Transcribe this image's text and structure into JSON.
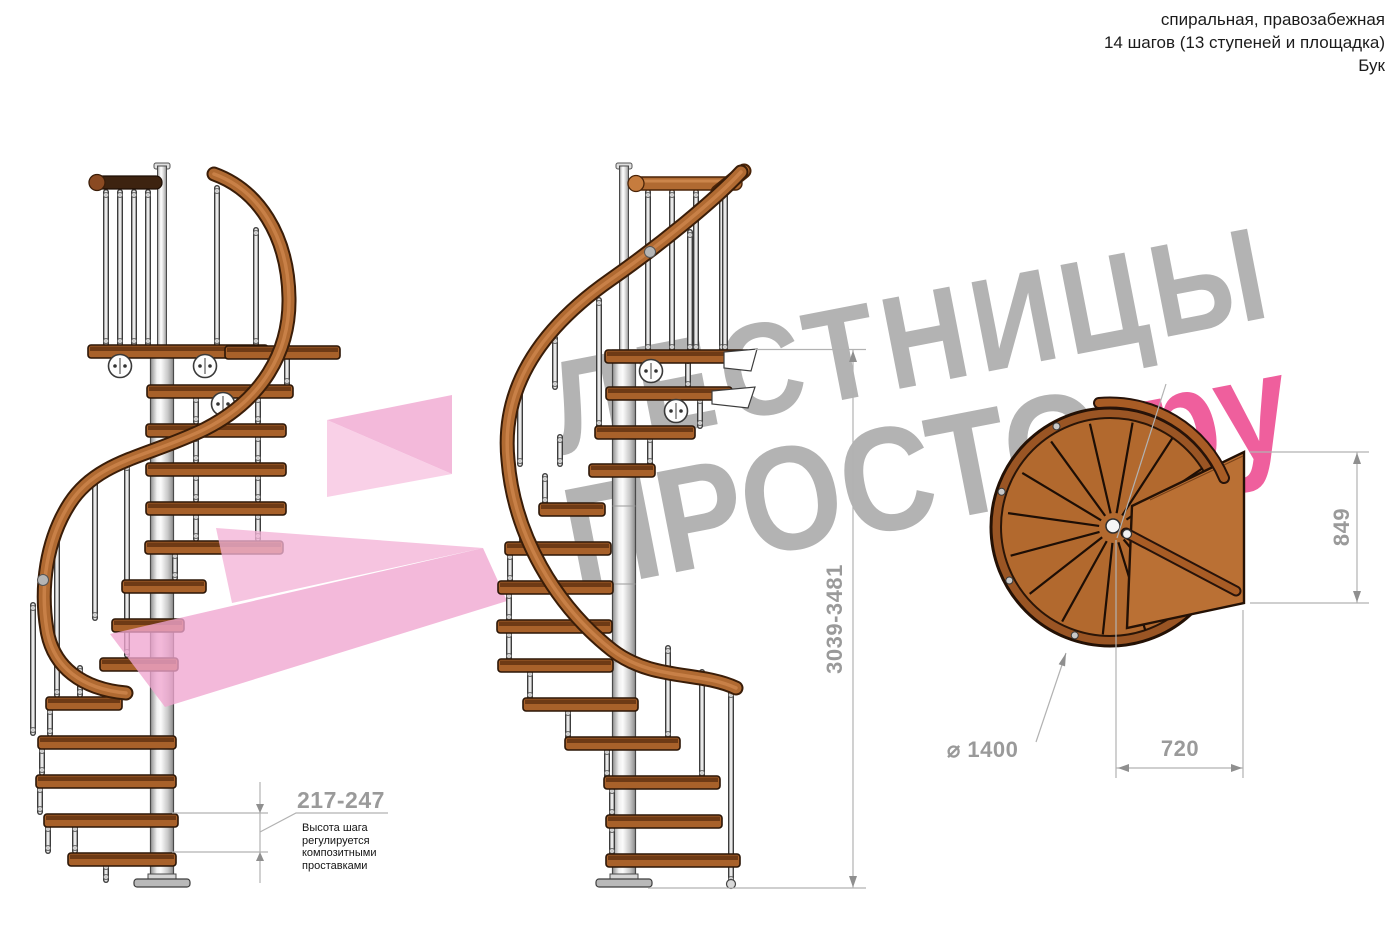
{
  "header": {
    "line1": "спиральная, правозабежная",
    "line2": "14 шагов (13 ступеней и площадка)",
    "line3": "Бук"
  },
  "watermark": {
    "word_top": "ЛЕСТНИЦЫ",
    "word_bottom": "ПРОСТО",
    "word_bottom_suffix": ".ру",
    "gray": "#b3b3b3",
    "pink": "#ef5f9d"
  },
  "dimensions": {
    "total_height": "3039-3481",
    "step_height": "217-247",
    "platform_depth": "849",
    "platform_width": "720",
    "diameter": "⌀ 1400"
  },
  "note": {
    "line1": "Высота шага",
    "line2": "регулируется",
    "line3": "композитными",
    "line4": "проставками"
  },
  "colors": {
    "wood_plan": "#b2692e",
    "arrow_dark": "#f0a5cf",
    "arrow_mid": "#f4b3d7",
    "arrow_light": "#f7c3e0",
    "dim_text": "#9a9a9a"
  }
}
